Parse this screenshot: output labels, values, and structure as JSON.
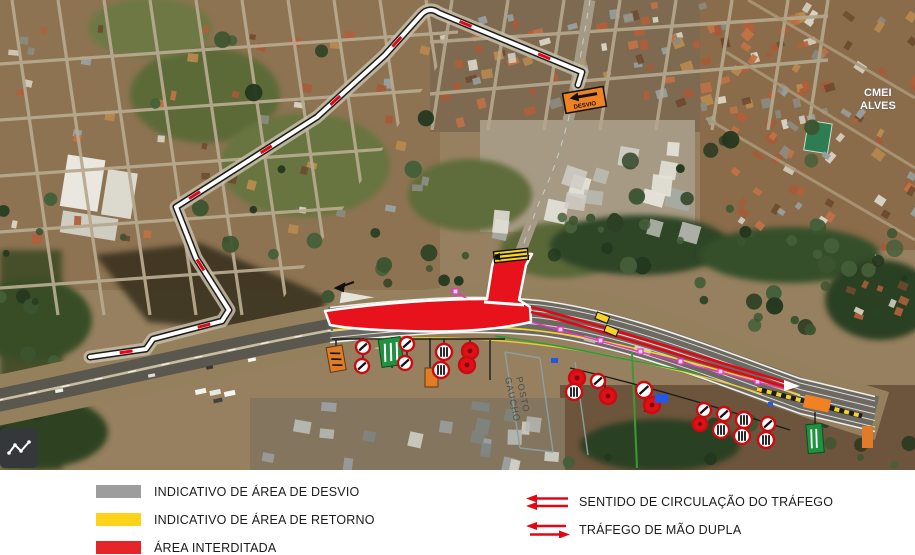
{
  "map": {
    "place_labels": {
      "cmei_line1": "CMEI",
      "cmei_line2": "ALVES",
      "posto_line1": "POSTO",
      "posto_line2": "GAUCHO"
    },
    "desvio_sign_label": "DESVIO",
    "overlay_colors": {
      "detour_route_white": "#ffffff",
      "route_casing_black": "#1c1c1c",
      "traffic_direction_red": "#e30613",
      "interdicted_red": "#e8121c",
      "return_yellow": "#f8d41c",
      "line_magenta": "#ee2fd2",
      "line_green": "#21a038",
      "line_yellow": "#f5d327",
      "sign_orange": "#f08223",
      "sign_green": "#1f9140",
      "marker_blue": "#2457e6"
    }
  },
  "controls": {
    "map_tool_icon": "polyline-icon"
  },
  "legend": {
    "items": [
      {
        "label": "INDICATIVO DE ÁREA DE DESVIO",
        "color": "#9d9d9d"
      },
      {
        "label": "INDICATIVO DE ÁREA DE RETORNO",
        "color": "#fbd319"
      },
      {
        "label": "ÁREA INTERDITADA",
        "color": "#e52528"
      }
    ],
    "arrow_items": [
      {
        "label": "SENTIDO DE CIRCULAÇÃO DO TRÁFEGO",
        "type": "one-way-pair"
      },
      {
        "label": "TRÁFEGO DE MÃO DUPLA",
        "type": "two-way"
      }
    ],
    "arrow_color": "#e30613"
  }
}
